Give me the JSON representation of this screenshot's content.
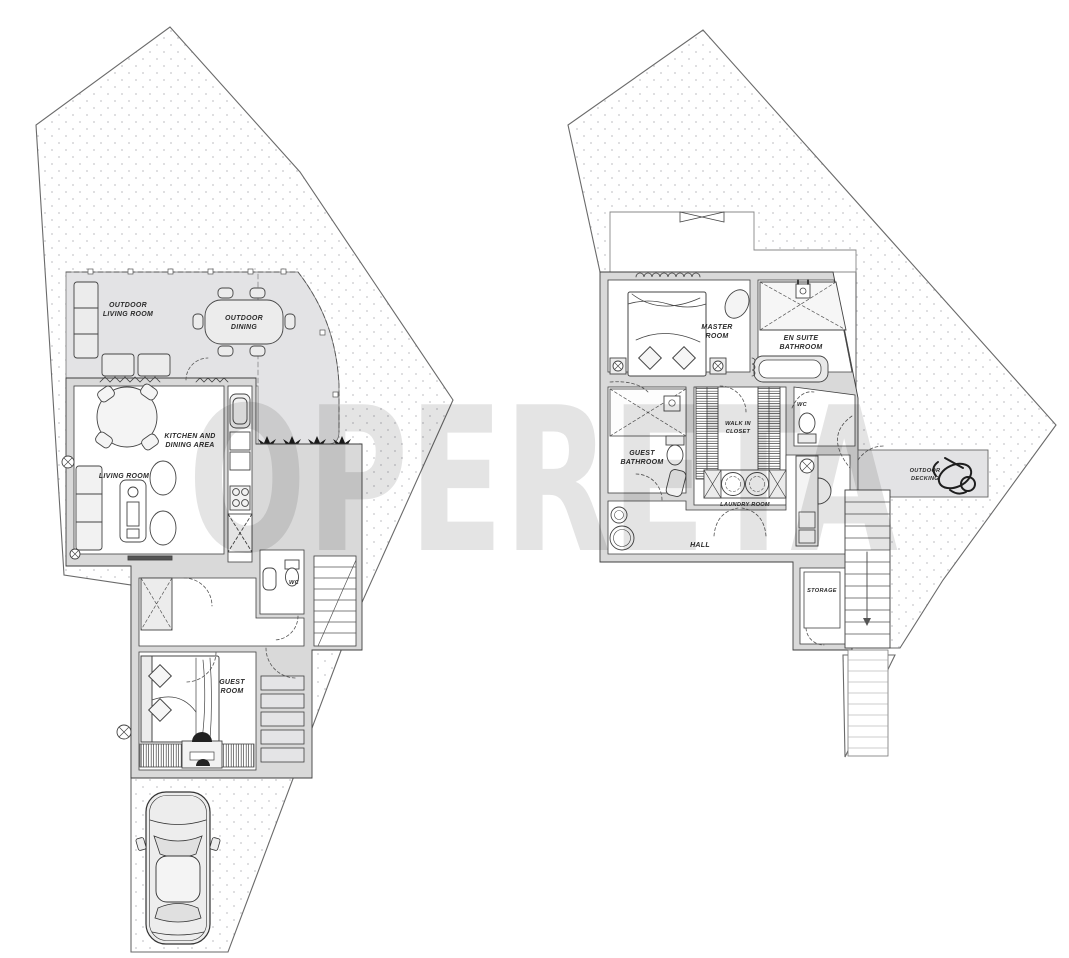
{
  "document": {
    "type": "architectural-floor-plan",
    "watermark": "OPERETA"
  },
  "colors": {
    "background": "#ffffff",
    "wall_fill": "#d9d9d9",
    "terrace_fill": "#e3e3e5",
    "roof_fill": "#ffffff",
    "line": "#3f3f3f",
    "site_dot": "#c8c8cc",
    "plant": "#1c1c1c",
    "watermark_gray": "#9a9a9a"
  },
  "floors": {
    "ground": {
      "labels": {
        "outdoor_living_room": [
          "OUTDOOR",
          "LIVING ROOM"
        ],
        "outdoor_dining": [
          "OUTDOOR",
          "DINING"
        ],
        "kitchen_dining": [
          "KITCHEN AND",
          "DINING AREA"
        ],
        "living_room": "LIVING ROOM",
        "wc": "WC",
        "guest_room": [
          "GUEST",
          "ROOM"
        ]
      }
    },
    "first": {
      "labels": {
        "master_room": [
          "MASTER",
          "ROOM"
        ],
        "en_suite_bathroom": [
          "EN SUITE",
          "BATHROOM"
        ],
        "guest_bathroom": [
          "GUEST",
          "BATHROOM"
        ],
        "walk_in_closet": [
          "WALK IN",
          "CLOSET"
        ],
        "wc": "WC",
        "laundry_room": "LAUNDRY ROOM",
        "hall": "HALL",
        "storage": "STORAGE",
        "outdoor_decking": [
          "OUTDOOR",
          "DECKING"
        ]
      }
    }
  }
}
